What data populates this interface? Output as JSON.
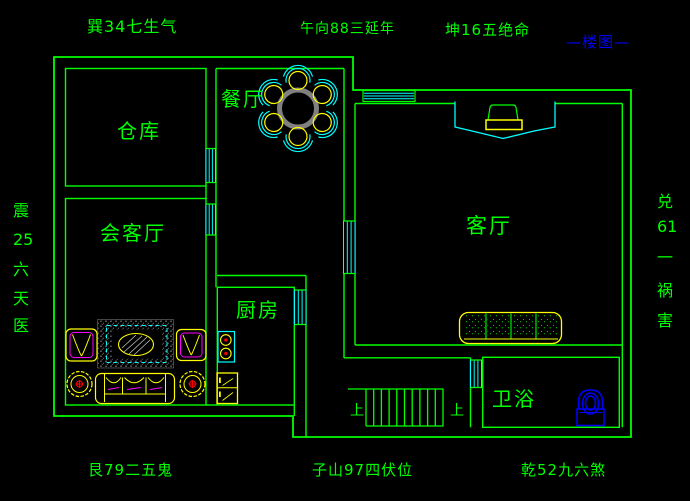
{
  "title": "—楼图—",
  "compass": {
    "top_left": "巽34七生气",
    "top_center": "午向88三延年",
    "top_right": "坤16五绝命",
    "bottom_left": "艮79二五鬼",
    "bottom_center": "子山97四伏位",
    "bottom_right": "乾52九六煞",
    "left": [
      "震",
      "25",
      "六",
      "天",
      "医"
    ],
    "right": [
      "兑",
      "61",
      "一",
      "祸",
      "害"
    ]
  },
  "rooms": {
    "storage": "仓库",
    "dining": "餐厅",
    "reception": "会客厅",
    "living": "客厅",
    "kitchen": "厨房",
    "bathroom": "卫浴"
  },
  "stairs": {
    "up_label_left": "上",
    "up_label_right": "上"
  },
  "colors": {
    "wall_green": "#00ff00",
    "window_cyan": "#00ffff",
    "furniture_yellow": "#ffff00",
    "accent_magenta": "#ff00ff",
    "annotation_blue": "#0000ff",
    "table_gray": "#808080",
    "detail_red": "#ff0000",
    "background": "#000000"
  }
}
